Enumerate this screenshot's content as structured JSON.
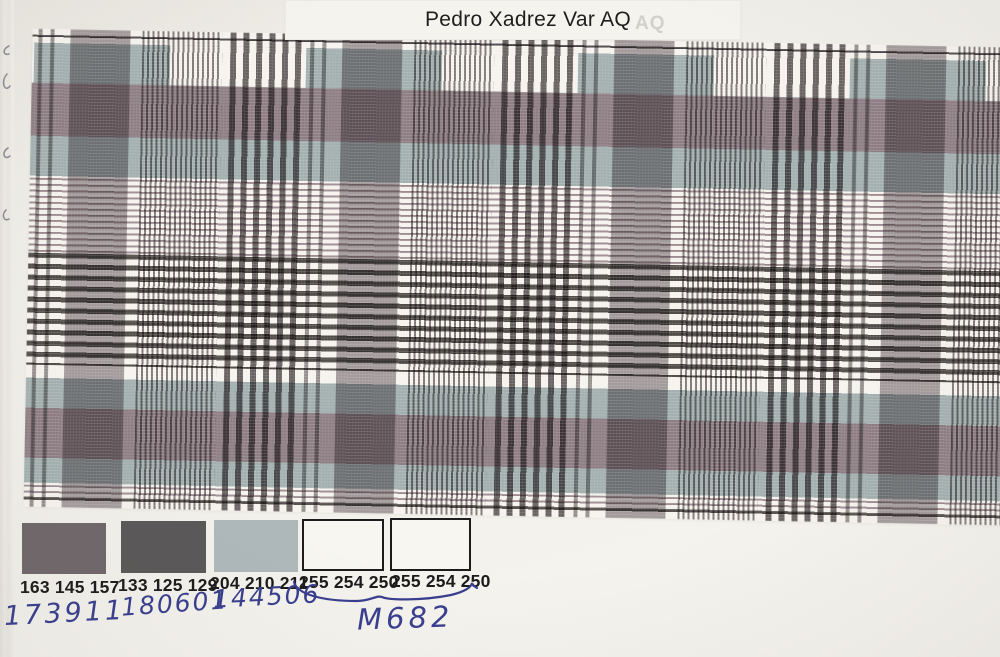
{
  "header": {
    "label_text": "Pedro Xadrez Var AQ",
    "ghost_text": "AQ"
  },
  "pattern_colors": {
    "ground": "#f6f3ee",
    "blue_gray_band": "#a2afae",
    "mauve_band": "#8d7d83",
    "dark_stripe": "#504b49",
    "hairline_stripe": "#9b8a90"
  },
  "swatches": [
    {
      "rgb_label": "163 145 157",
      "fill": "#6f6769",
      "outlined": false,
      "handwritten_code": "173911"
    },
    {
      "rgb_label": "133 125 129",
      "fill": "#5a5858",
      "outlined": false,
      "handwritten_code": "180601"
    },
    {
      "rgb_label": "204 210 211",
      "fill": "#aeb8ba",
      "outlined": false,
      "handwritten_code": "144506"
    },
    {
      "rgb_label": "255 254 250",
      "fill": "#f7f6f1",
      "outlined": true,
      "handwritten_code": ""
    },
    {
      "rgb_label": "255 254 250",
      "fill": "#f7f6f1",
      "outlined": true,
      "handwritten_code": ""
    }
  ],
  "handwritten": {
    "group_code": "M682",
    "ink_color": "#383e8e"
  }
}
